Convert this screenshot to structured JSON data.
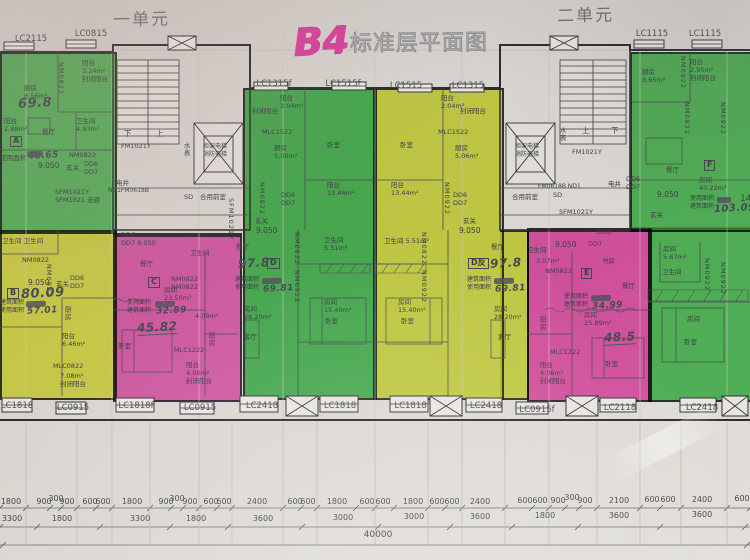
{
  "title": {
    "code": "B4",
    "name": "标准层平面图"
  },
  "units": {
    "left": "一单元",
    "right": "二单元"
  },
  "windows_top": [
    "LC2115",
    "LC0815",
    "LC1315f",
    "LC1515f",
    "LC1515",
    "LC1315",
    "LC1115",
    "LC1115"
  ],
  "windows_bottom": [
    "LC1818",
    "LC0915",
    "LC1818f",
    "LC0915",
    "LC2418",
    "LC1818",
    "LC1818f",
    "LC2418",
    "LC0915f",
    "LC2118",
    "LC2418"
  ],
  "dims": {
    "row1": [
      "1800",
      "900",
      "300",
      "900",
      "600",
      "600",
      "1800",
      "900",
      "300",
      "900",
      "600",
      "600",
      "2400",
      "600",
      "600",
      "1800",
      "600",
      "600",
      "1800",
      "600",
      "600",
      "2400",
      "600",
      "600",
      "900",
      "300",
      "900",
      "2100",
      "600",
      "600",
      "2400",
      "600"
    ],
    "row2": [
      "3300",
      "1800",
      "3300",
      "1800",
      "3600",
      "3000",
      "3000",
      "3600",
      "1800",
      "3600",
      "3600"
    ],
    "total": "40000"
  },
  "colors": {
    "green_a": "#66d06e",
    "green_d": "#52c75f",
    "green_f": "#5bcb66",
    "yellow_b": "#eaf058",
    "yellow_dr": "#dfec52",
    "pink_c": "#f26ac4",
    "pink_e": "#f05fbc",
    "marker": "#d6419d"
  },
  "L": {
    "a_k": "厨房\n8.56m²",
    "a_bal": "阳台\n3.24m²\n封闭阳台",
    "a_nm1": "NM0822",
    "a_hw": "69.8",
    "a_bal2": "阳台\n2.88m²",
    "a_din": "餐厅",
    "a_tag": "A",
    "a_lbl": "使用面积",
    "a_usev": "48.65",
    "a_lvl": "9.050",
    "a_entry": "玄关",
    "a_nm2": "NM0822",
    "a_dd": "DD6\nDD7",
    "a_wc": "卫生间\n4.93m²",
    "a_sf": "SFM1021Y\nSFM1021 走廊",
    "c1_din": "电井",
    "c1_nd": "ND1FM0618B",
    "c1_fm": "FM1021Y",
    "c1_sb": "水表",
    "c1_sd": "SD",
    "c1_hall": "合用前室",
    "c1_dn": "下",
    "c1_up": "上",
    "c1_el": "担架电梯\n消防电梯",
    "c2_sb": "水表",
    "c2_fm": "FM1021Y",
    "c2_up": "上",
    "c2_dn": "下",
    "c2_el": "担架电梯\n消防电梯",
    "c2_nd": "FM0618B ND1",
    "c2_sd": "SD",
    "c2_hall": "合用前室",
    "c2_din": "电井",
    "c2_sf": "SFM1021Y",
    "mid_sf": "SFM1021Y",
    "b_wc": "卫生间  卫生间",
    "b_nm1": "NM0822",
    "b_lvl": "9.050",
    "b_entry": "玄关",
    "b_dd": "DD6\nDD7",
    "b_tag": "B",
    "b_hw": "80.09",
    "b_lbls": "建筑面积\n使用面积",
    "b_usev": "57.01",
    "b_nm2": "NM0822",
    "b_k": "厨房",
    "b_bal": "阳台\n6.46m²",
    "b_ml": "MLC0822",
    "b_bal2": "7.08m²\n封闭阳台",
    "cc_dd": "DD6\nDD7 9.050",
    "cc_din": "餐厅",
    "cc_tag": "C",
    "cc_rm": "房间\n23.50m²",
    "cc_lbls": "使用面积\n建筑面积",
    "cc_usev": "32.89",
    "cc_hw": "45.82",
    "cc_bed": "卧室",
    "cc_nm": "NM0822\nNM0822",
    "cc_wc": "卫生间",
    "cc_wca": "4.09m²",
    "cc_k": "厨房",
    "cc_ml": "MLC1222",
    "cc_bal": "阳台\n4.06m²\n封闭阳台",
    "d_balc": "封闭阳台",
    "d_bal": "阳台\n2.04m²",
    "d_ml": "MLC1522",
    "d_k": "厨房\n5.06m²",
    "d_bed1": "卧室",
    "d_bal2": "阳台\n13.46m²",
    "d_nm1": "NM0822",
    "d_dd": "DD6\nDD7",
    "d_entry": "玄关",
    "d_lvl": "9.050",
    "d_din": "餐厅",
    "d_hw": "97.8",
    "d_tag": "D",
    "d_lbls": "建筑面积\n使用面积",
    "d_usev": "69.81",
    "d_wc": "卫生间\n5.51m²",
    "d_nm2": "NM0822",
    "d_nm3": "NM0922",
    "d_rm1": "房间\n15.40m²",
    "d_bed2": "卧室",
    "d_rm2": "房间\n28.20m²",
    "d_liv": "客厅",
    "r_balc": "封闭阳台",
    "r_bal": "阳台\n2.04m²",
    "r_ml": "MLC1522",
    "r_k": "厨房\n5.06m²",
    "r_bed1": "卧室",
    "r_bal2": "阳台\n13.44m²",
    "r_nm1": "NM0922",
    "r_dd": "DD6\nDD7",
    "r_entry": "玄关",
    "r_lvl": "9.050",
    "r_din": "餐厅",
    "r_hw": "97.8",
    "r_tag": "D反",
    "r_lbls": "建筑面积\n使用面积",
    "r_usev": "69.81",
    "r_wc": "卫生间 5.51m²",
    "r_nm2": "NM0822",
    "r_nm3": "NM0922",
    "r_rm1": "房间\n15.40m²",
    "r_bed2": "卧室",
    "r_rm2": "房间\n28.20m²",
    "r_liv": "客厅",
    "e_dd6": "DD6",
    "e_lvl": "9.050",
    "e_dd7": "DD7",
    "e_wc": "卫生间",
    "e_wca": "3.07m²",
    "e_nm1": "NM0822",
    "e_tag": "E",
    "e_srm": "书房",
    "e_din": "餐厅",
    "e_lbls": "使用面积\n建筑面积",
    "e_usev": "34.99",
    "e_rm": "房间\n25.89m²",
    "e_hw": "48.5",
    "e_k": "厨房",
    "e_bed": "卧室",
    "e_ml": "MLC1222",
    "e_bal": "阳台\n4.06m²\n封闭阳台",
    "f_k": "厨房\n8.65m²",
    "f_bal": "阳台\n2.95m²\n封闭阳台",
    "f_nm1": "NM0922",
    "f_nm2": "NM0822",
    "f_nm3": "NM0922",
    "f_din": "餐厅",
    "f_dd": "DD6\nDD7",
    "f_lvl": "9.050",
    "f_tag": "F",
    "f_rm0": "房间\n40.22m²",
    "f_lbls": "使用面积\n建筑面积",
    "f_usev": "103.09",
    "f_edge": "14",
    "f_entry": "玄关",
    "f_rm1": "房间\n5.67m²",
    "f_wc": "卫生间",
    "f_nm4": "NM0922",
    "f_nm5": "NM0922",
    "f_rm2": "房间",
    "f_bed": "卧室"
  }
}
